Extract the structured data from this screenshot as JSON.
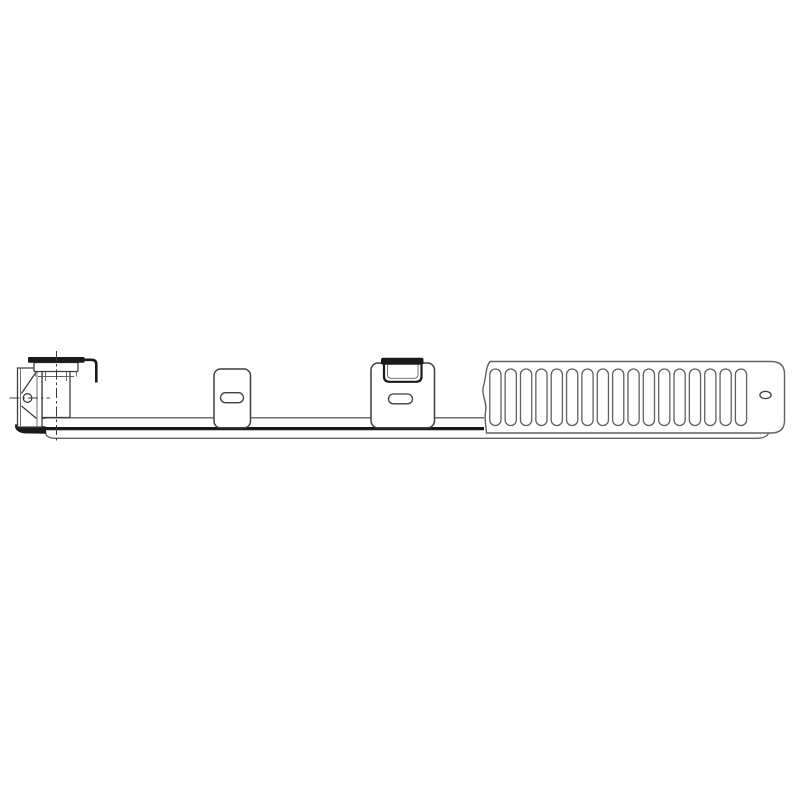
{
  "figure": {
    "type": "technical-line-drawing",
    "subject": "Side-profile drawing of a mounting rail with wall hook bracket, two fixing clips and a slotted ventilation grille panel",
    "background": "#ffffff"
  },
  "colors": {
    "background": "#ffffff",
    "outline": "#3f3f3f",
    "light_outline": "#616161",
    "heavy": "#1a1a1a",
    "centerline": "#3a3a3a",
    "fill": "#ffffff"
  },
  "grille": {
    "slot_count": 17,
    "slot_start_x": 489.8,
    "slot_pitch": 15.35,
    "slot_width": 11.2,
    "slot_top_y": 369,
    "slot_height": 56.5,
    "slot_corner_radius": 5.5
  },
  "parts": {
    "wall_bracket": "wall-hook-bracket",
    "clip_small": "fixing-clip",
    "clip_hook": "hook-clip",
    "rail": "bottom-rail",
    "grille_panel": "ventilation-grille-panel",
    "hole": "fixing-hole"
  }
}
